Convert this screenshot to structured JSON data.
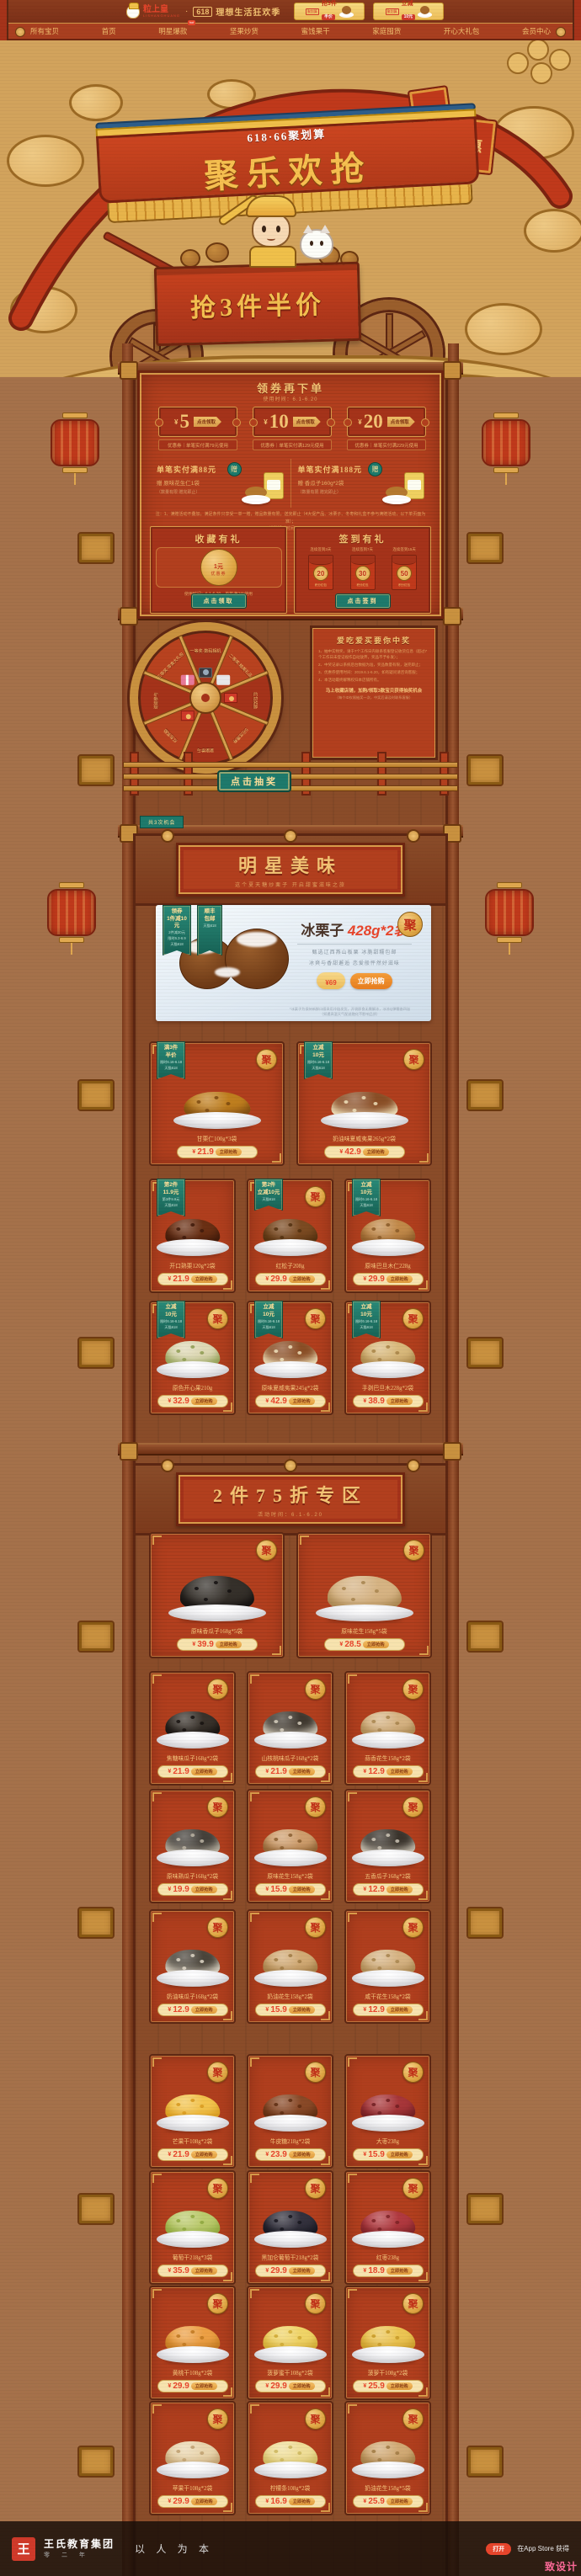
{
  "shared": {
    "buy": "立即抢购",
    "ju": "聚",
    "currency": "¥"
  },
  "topbar": {
    "logo": "粒上皇",
    "logo_sub": "LISHANGHUANG",
    "dot": "·",
    "slogan_badge": "618",
    "slogan": "理想生活狂欢季",
    "cards": [
      {
        "tag": "聚划算",
        "line1": "抢3件",
        "line2": "半价"
      },
      {
        "tag": "聚划算",
        "line1": "立减",
        "line2": "10元"
      }
    ]
  },
  "nav": {
    "items": [
      "所有宝贝",
      "首页",
      "明星爆款",
      "坚果炒货",
      "蜜饯果干",
      "家庭囤货",
      "开心大礼包",
      "会员中心"
    ],
    "hot": "hot"
  },
  "hero": {
    "banner_badge": "618·66聚划算",
    "title": "聚乐欢抢",
    "cart_text": "抢3件半价",
    "flag_char": "惠"
  },
  "coupon_section": {
    "title": "领券再下单",
    "subtitle": "使用时间：6.1-6.20",
    "coupons": [
      {
        "currency": "¥",
        "amount": "5",
        "claim": "点击领取",
        "footnote": "优惠券｜单笔实付满79元使用"
      },
      {
        "currency": "¥",
        "amount": "10",
        "claim": "点击领取",
        "footnote": "优惠券｜单笔实付满129元使用"
      },
      {
        "currency": "¥",
        "amount": "20",
        "claim": "点击领取",
        "footnote": "优惠券｜单笔实付满229元使用"
      }
    ]
  },
  "gift_section": {
    "panels": [
      {
        "badge": "赠",
        "title": "单笔实付满88元",
        "gift": "赠 原味花生仁1袋",
        "note": "（数量有限 赠完即止）"
      },
      {
        "badge": "赠",
        "title": "单笔实付满188元",
        "gift": "赠 香瓜子160g*2袋",
        "note": "（数量有限 赠完即止）"
      }
    ],
    "note1": "注：1、满赠活动不叠加，满足条件只享受一单一赠，赠品数量有限，送完即止（4大促产品、冰栗子、冬枣和礼盒不参与满赠活动，以下单页面为准）；",
    "note2": "2、满赠活动时间：6.1-6.20。"
  },
  "collect": {
    "left": {
      "title": "收藏有礼",
      "coin_big": "1",
      "coin_unit": "元",
      "coin_label": "优惠券",
      "note": "使用时间：6.1-6.20，单笔满2元使用",
      "button": "点击领取"
    },
    "right": {
      "title": "签到有礼",
      "button": "点击签到",
      "items": [
        {
          "label": "连续签到3天",
          "value": "20",
          "unit": "积分红包"
        },
        {
          "label": "连续签到7天",
          "value": "30",
          "unit": "积分红包"
        },
        {
          "label": "连续签到15天",
          "value": "50",
          "unit": "积分红包"
        }
      ]
    }
  },
  "wheel": {
    "prizes": [
      "一等奖·数码相机",
      "二等奖·精美礼品",
      "红包奖励",
      "5元优惠券",
      "谢谢参与",
      "红包奖励",
      "谢谢参与",
      "三等奖·零食大礼包"
    ],
    "button": "点击抽奖",
    "extra": "共3次机会",
    "rules_title": "爱吃爱买要你中奖",
    "rules": [
      "1、抽中实物奖，请于7个工作日内联系客服登记收货信息（超过7个工作日未登记视作自动放弃，奖品不予补发）；",
      "2、中奖记录以系统后台数据为准，奖品数量有限，送完即止；",
      "3、优惠券使用时间：2019.6.1-6.20，如有疑问请咨询客服；",
      "4、本活动最终解释权归本店铺所有。"
    ],
    "cta": "马上收藏店铺，加购/领取3款宝贝获得抽奖机会",
    "cta_sub": "（每个ID仅限抽奖一次，中奖后请及时联系客服）"
  },
  "star": {
    "title": "明星美味",
    "subtitle": "这个夏天糖炒栗子 开启甜蜜滋味之旅",
    "hero": {
      "ribbons": [
        [
          "领券",
          "1件减10元",
          "2件减30元",
          "限时6.3-6.9",
          "天猫618"
        ],
        [
          "顺丰",
          "包邮",
          "天猫618"
        ]
      ],
      "badge": "聚",
      "title_black": "冰栗子",
      "title_red": "428g*2袋",
      "sub1": "甄选辽西燕山板栗 冰脆甜糯包邮",
      "sub2": "冰爽与香甜邂逅 恋爱般怦然好滋味",
      "currency": "¥",
      "price": "69",
      "button": "立即抢购",
      "fine1": "*冰栗子为保持新鲜口感采用冷链发货，开袋即食无需解冻，冰凉Q弹糯香四溢",
      "fine2": "（如遇高温天气配送融化不影响品质）"
    },
    "rows": [
      {
        "wide": true,
        "items": [
          {
            "name": "甘栗仁100g*3袋",
            "price": "21.9",
            "ju": true,
            "c1": "#c07f1f",
            "c2": "#7c4a10",
            "ribbon": [
              "满3件",
              "半价",
              "限时6.16-6.18",
              "天猫618"
            ]
          },
          {
            "name": "奶油味夏威夷果265g*2袋",
            "price": "42.9",
            "ju": true,
            "c1": "#8a4e26",
            "c2": "#f0e2bc",
            "ribbon": [
              "立减",
              "10元",
              "限时6.16-6.18",
              "天猫618"
            ]
          }
        ]
      },
      {
        "wide": false,
        "items": [
          {
            "name": "开口熟栗120g*2袋",
            "price": "21.9",
            "ju": false,
            "c1": "#6b3014",
            "c2": "#3f1a0a",
            "ribbon": [
              "第2件",
              "11.9元",
              "第3件9.9元",
              "天猫618"
            ]
          },
          {
            "name": "红松子208g",
            "price": "29.9",
            "ju": true,
            "c1": "#7c4b22",
            "c2": "#52300f",
            "ribbon": [
              "第2件",
              "立减10元",
              "天猫618"
            ]
          },
          {
            "name": "原味巴旦木仁228g",
            "price": "29.9",
            "ju": false,
            "c1": "#c28a4a",
            "c2": "#8a5a28",
            "ribbon": [
              "立减",
              "10元",
              "限时6.16-6.18",
              "天猫618"
            ]
          }
        ]
      },
      {
        "wide": false,
        "items": [
          {
            "name": "原色开心果210g",
            "price": "32.9",
            "ju": true,
            "c1": "#ded8b4",
            "c2": "#8f9e52",
            "ribbon": [
              "立减",
              "10元",
              "限时6.16-6.18",
              "天猫618"
            ]
          },
          {
            "name": "原味夏威夷果245g*2袋",
            "price": "42.9",
            "ju": true,
            "c1": "#8a4e26",
            "c2": "#f0e2bc",
            "ribbon": [
              "立减",
              "10元",
              "限时6.16-6.18",
              "天猫618"
            ]
          },
          {
            "name": "手剥巴旦木228g*2袋",
            "price": "38.9",
            "ju": true,
            "c1": "#d9b97c",
            "c2": "#a88448",
            "ribbon": [
              "立减",
              "10元",
              "限时6.16-6.18",
              "天猫618"
            ]
          }
        ]
      }
    ]
  },
  "discount": {
    "title": "2件75折专区",
    "subtitle": "活动时间：6.1-6.20",
    "rows": [
      {
        "wide": true,
        "items": [
          {
            "name": "原味香瓜子168g*5袋",
            "price": "39.9",
            "ju": true,
            "c1": "#35302a",
            "c2": "#141110"
          },
          {
            "name": "原味花生158g*5袋",
            "price": "28.5",
            "ju": true,
            "c1": "#d6b383",
            "c2": "#a8854f"
          }
        ]
      },
      {
        "wide": false,
        "items": [
          {
            "name": "焦糖味瓜子168g*2袋",
            "price": "21.9",
            "ju": true,
            "c1": "#3a332c",
            "c2": "#171310"
          },
          {
            "name": "山核桃味瓜子168g*2袋",
            "price": "21.9",
            "ju": true,
            "c1": "#3f382f",
            "c2": "#d8d0c0"
          },
          {
            "name": "蒜香花生158g*2袋",
            "price": "12.9",
            "ju": true,
            "c1": "#d6b383",
            "c2": "#a8854f"
          }
        ]
      },
      {
        "wide": false,
        "items": [
          {
            "name": "原味熟瓜子168g*2袋",
            "price": "19.9",
            "ju": true,
            "c1": "#44403a",
            "c2": "#bdb5a5"
          },
          {
            "name": "原味花生158g*2袋",
            "price": "15.9",
            "ju": true,
            "c1": "#cf9f6e",
            "c2": "#8a5e30"
          },
          {
            "name": "五香瓜子168g*2袋",
            "price": "12.9",
            "ju": true,
            "c1": "#3a342c",
            "c2": "#d0c8b8"
          }
        ]
      },
      {
        "wide": false,
        "items": [
          {
            "name": "奶油味瓜子168g*2袋",
            "price": "12.9",
            "ju": true,
            "c1": "#4a443a",
            "c2": "#e0d8c8"
          },
          {
            "name": "奶油花生158g*2袋",
            "price": "15.9",
            "ju": true,
            "c1": "#d2ab76",
            "c2": "#a07a44"
          },
          {
            "name": "咸干花生158g*2袋",
            "price": "12.9",
            "ju": true,
            "c1": "#d6b383",
            "c2": "#a8854f"
          }
        ]
      },
      {
        "wide": false,
        "items": [
          {
            "name": "芒果干108g*2袋",
            "price": "21.9",
            "ju": true,
            "c1": "#f3c44e",
            "c2": "#d89a1e"
          },
          {
            "name": "牛皮糖218g*2袋",
            "price": "23.9",
            "ju": true,
            "c1": "#8a4a28",
            "c2": "#5e2d12"
          },
          {
            "name": "大枣238g",
            "price": "15.9",
            "ju": true,
            "c1": "#a8373a",
            "c2": "#701f22"
          }
        ]
      },
      {
        "wide": false,
        "items": [
          {
            "name": "葡萄干218g*3袋",
            "price": "35.9",
            "ju": true,
            "c1": "#bccb6e",
            "c2": "#8fa83e"
          },
          {
            "name": "黑加仑葡萄干218g*2袋",
            "price": "29.9",
            "ju": true,
            "c1": "#34323e",
            "c2": "#17161f"
          },
          {
            "name": "红枣238g",
            "price": "18.9",
            "ju": true,
            "c1": "#b23a40",
            "c2": "#7c2226"
          }
        ]
      },
      {
        "wide": false,
        "items": [
          {
            "name": "黄桃干108g*2袋",
            "price": "29.9",
            "ju": true,
            "c1": "#eda045",
            "c2": "#c07820"
          },
          {
            "name": "菠萝蜜干108g*2袋",
            "price": "29.9",
            "ju": true,
            "c1": "#f0d468",
            "c2": "#cfa832"
          },
          {
            "name": "菠萝干108g*2袋",
            "price": "25.9",
            "ju": true,
            "c1": "#ecc554",
            "c2": "#c89a28"
          }
        ]
      },
      {
        "wide": false,
        "items": [
          {
            "name": "苹果干108g*2袋",
            "price": "29.9",
            "ju": true,
            "c1": "#ead6ae",
            "c2": "#c0a070"
          },
          {
            "name": "柠檬条108g*2袋",
            "price": "16.9",
            "ju": true,
            "c1": "#f0df9a",
            "c2": "#cdb75e"
          },
          {
            "name": "奶油花生158g*5袋",
            "price": "25.9",
            "ju": true,
            "c1": "#d2ab76",
            "c2": "#a07a44"
          }
        ]
      }
    ]
  },
  "footer": {
    "logo_char": "王",
    "brand": "王氏教育集团",
    "slogan": "以 人 为 本",
    "sub": "零 二 年",
    "right": "在App Store 获得",
    "badge": "打开",
    "watermark": "致设计"
  }
}
